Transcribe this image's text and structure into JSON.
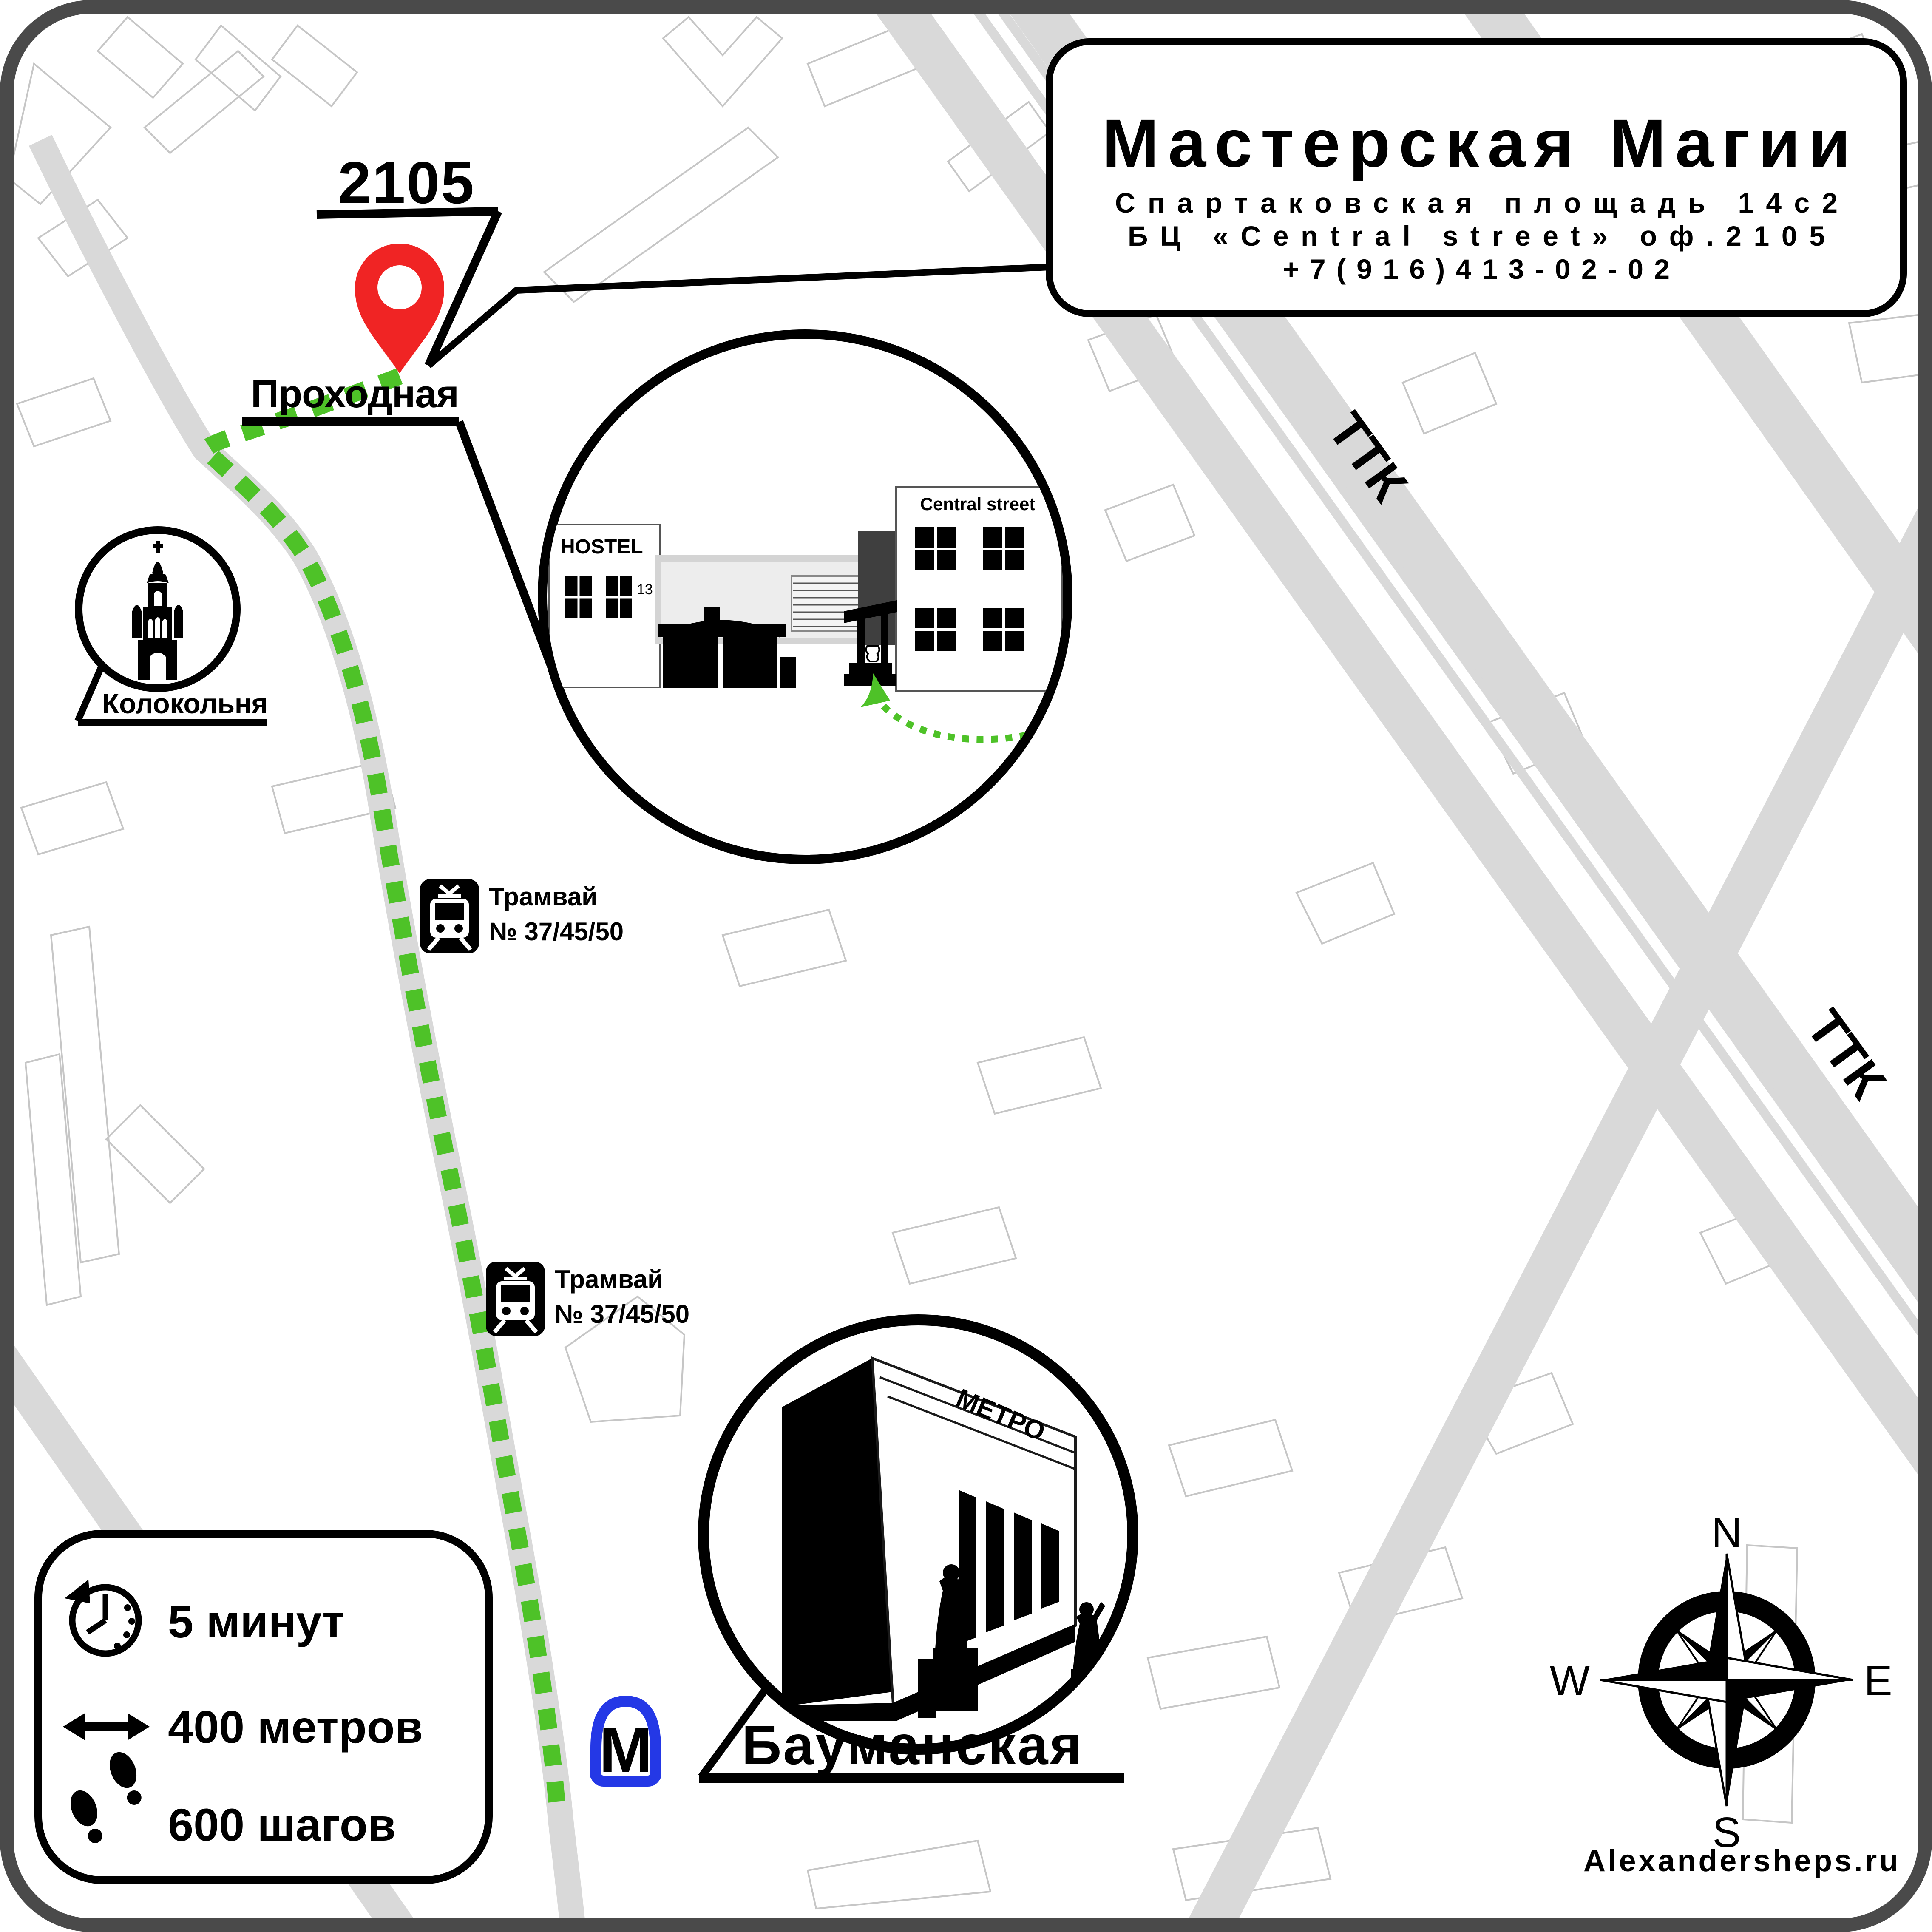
{
  "header": {
    "title": "Мастерская Магии",
    "address_line1": "Спартаковская площадь 14с2",
    "address_line2": "БЦ «Central street» оф.2105",
    "phone": "+7(916)413-02-02"
  },
  "pin": {
    "office_label": "2105"
  },
  "labels": {
    "entrance": "Проходная",
    "bell_tower": "Колокольня",
    "metro_station": "Бауманская",
    "ttk": "ТТК"
  },
  "inset": {
    "hostel_name": "HOSTEL",
    "hostel_number": "13",
    "business_center": "Central street"
  },
  "metro": {
    "logo": "М",
    "sign": "МЕТРО"
  },
  "tram_stops": [
    {
      "line1": "Трамвай",
      "line2": "№ 37/45/50"
    },
    {
      "line1": "Трамвай",
      "line2": "№ 37/45/50"
    }
  ],
  "stats": {
    "time": "5 минут",
    "distance": "400 метров",
    "steps": "600 шагов"
  },
  "compass": {
    "north": "N",
    "south": "S",
    "west": "W",
    "east": "E"
  },
  "footer": {
    "website": "Alexandersheps.ru"
  },
  "colors": {
    "route_green": "#4ec228",
    "pin_red": "#f02424",
    "metro_blue": "#2438e6",
    "road_gray": "#d9d9d9"
  }
}
